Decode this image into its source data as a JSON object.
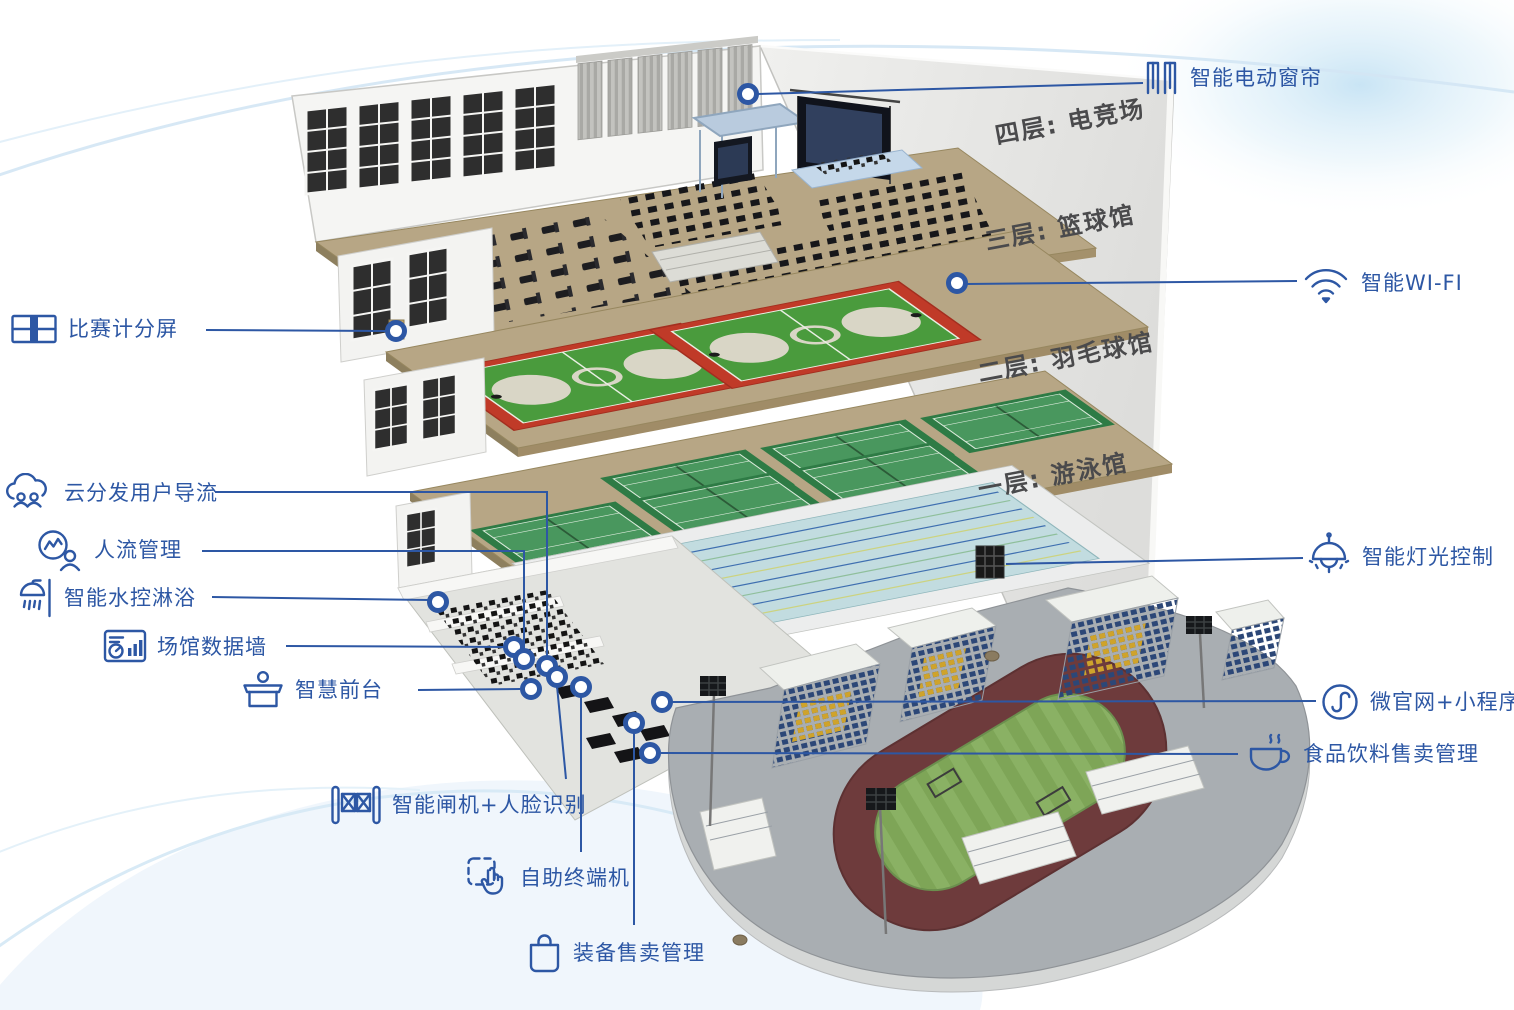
{
  "title": "智慧场馆分层示意图",
  "floors": [
    {
      "label": "四层: 电竞场"
    },
    {
      "label": "三层: 篮球馆"
    },
    {
      "label": "二层: 羽毛球馆"
    },
    {
      "label": "一层: 游泳馆"
    }
  ],
  "callouts": {
    "curtain": {
      "label": "智能电动窗帘",
      "icon": "curtain-icon"
    },
    "wifi": {
      "label": "智能WI-FI",
      "icon": "wifi-icon"
    },
    "light": {
      "label": "智能灯光控制",
      "icon": "pendant-lamp-icon"
    },
    "miniprogram": {
      "label": "微官网+小程序",
      "icon": "miniprogram-icon"
    },
    "food": {
      "label": "食品饮料售卖管理",
      "icon": "coffee-cup-icon"
    },
    "scoreboard": {
      "label": "比赛计分屏",
      "icon": "scoreboard-icon"
    },
    "cloud": {
      "label": "云分发用户导流",
      "icon": "cloud-users-icon"
    },
    "people_flow": {
      "label": "人流管理",
      "icon": "flow-chart-person-icon"
    },
    "shower": {
      "label": "智能水控淋浴",
      "icon": "shower-icon"
    },
    "data_wall": {
      "label": "场馆数据墙",
      "icon": "data-dashboard-icon"
    },
    "front_desk": {
      "label": "智慧前台",
      "icon": "reception-desk-icon"
    },
    "gate": {
      "label": "智能闸机+人脸识别",
      "icon": "turnstile-gate-icon"
    },
    "terminal": {
      "label": "自助终端机",
      "icon": "touch-kiosk-icon"
    },
    "equipment": {
      "label": "装备售卖管理",
      "icon": "shopping-bag-icon"
    }
  },
  "colors": {
    "accent": "#2d57a4",
    "floor_label": "#4a4a4c",
    "wall": "#ececea",
    "slab_tan": "#b7a685",
    "court_red": "#c03a28",
    "court_green": "#4a9b3d",
    "badminton_green": "#49975e",
    "pool_water": "#c2dce0",
    "lane_blue": "#3f6fb0",
    "track_maroon": "#6e3b3c",
    "field_green": "#83a95c",
    "seat_blue": "#2c4777",
    "seat_yellow": "#cfa32b"
  }
}
